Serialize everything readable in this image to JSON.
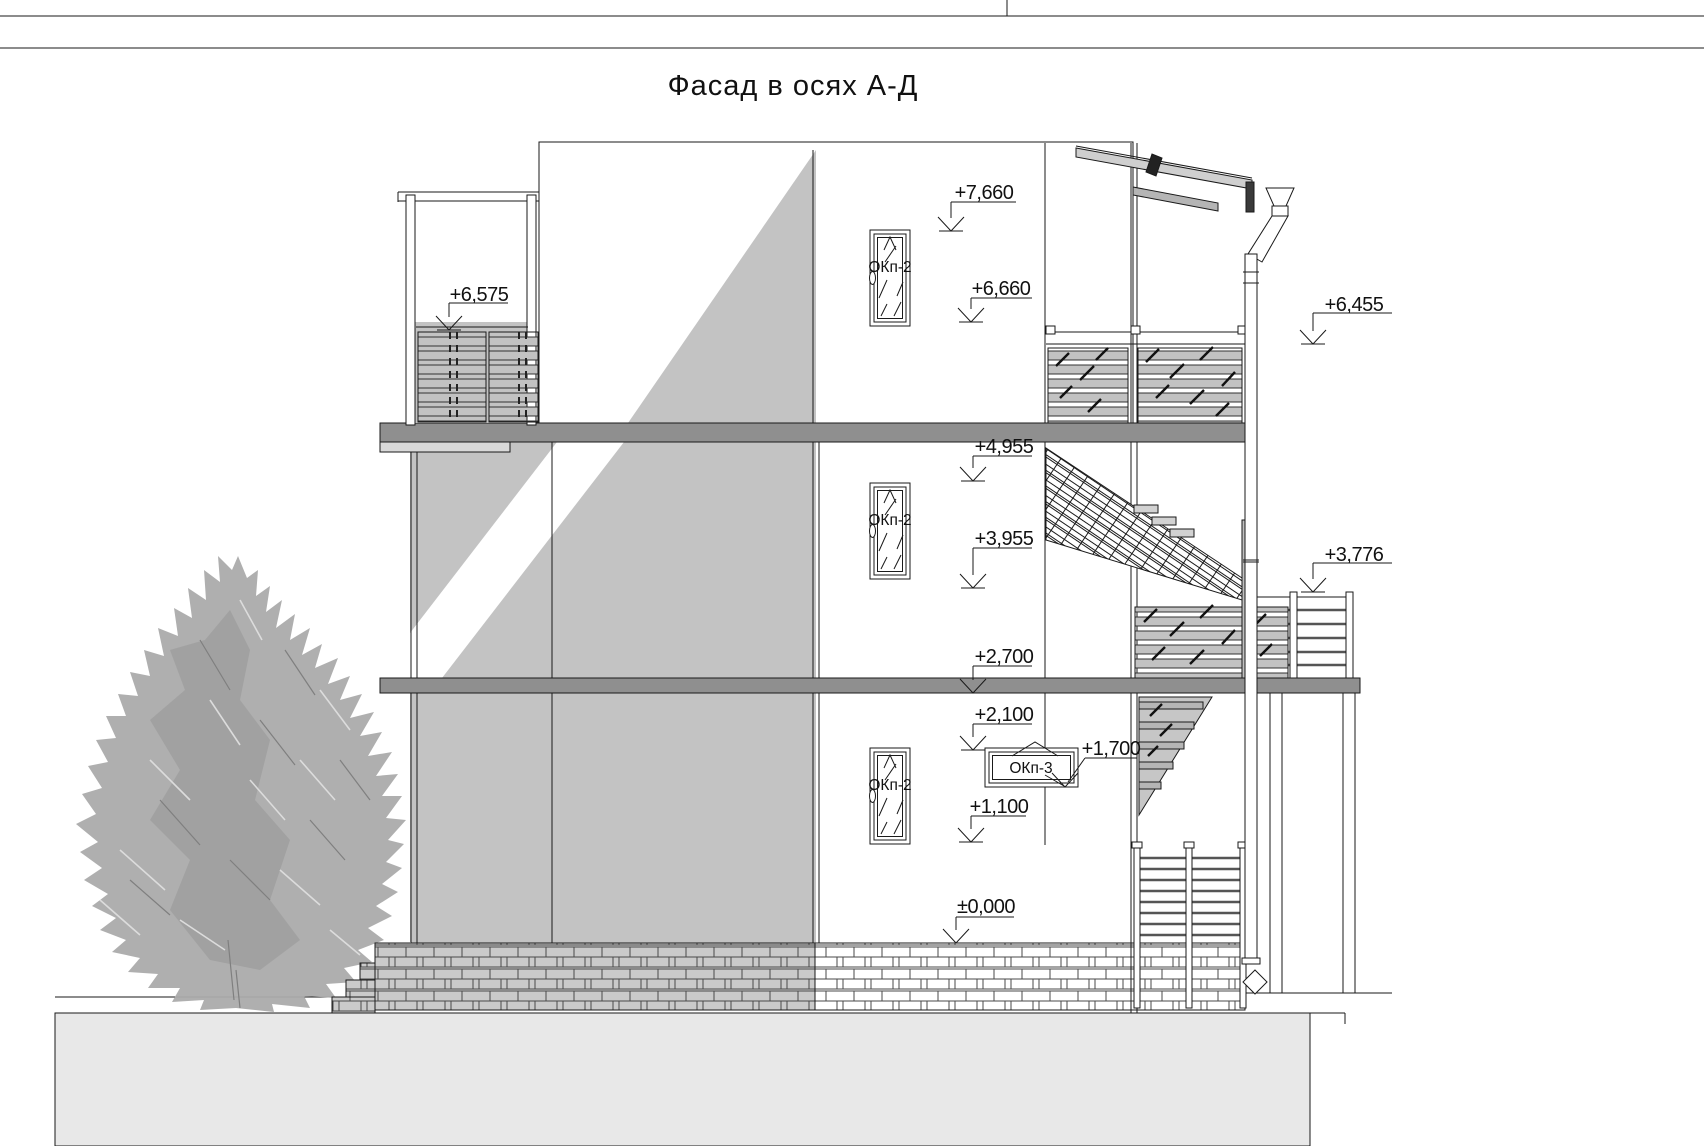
{
  "title": "Фасад в осях А-Д",
  "markers": {
    "m7660": "+7,660",
    "m6660": "+6,660",
    "m6575": "+6,575",
    "m6455": "+6,455",
    "m4955": "+4,955",
    "m3955": "+3,955",
    "m3776": "+3,776",
    "m2700": "+2,700",
    "m2100": "+2,100",
    "m1700": "+1,700",
    "m1100": "+1,100",
    "m0000": "±0,000"
  },
  "windows": {
    "okp2": "ОКп-2",
    "okp3": "ОКп-3"
  },
  "colors": {
    "line": "#1a1a1a",
    "wall": "#c3c3c3",
    "slab": "#8f8f8f",
    "ground": "#e8e8e8",
    "brick": "#cacaca",
    "rail": "#c2c2c2",
    "tree": "#ababab"
  }
}
